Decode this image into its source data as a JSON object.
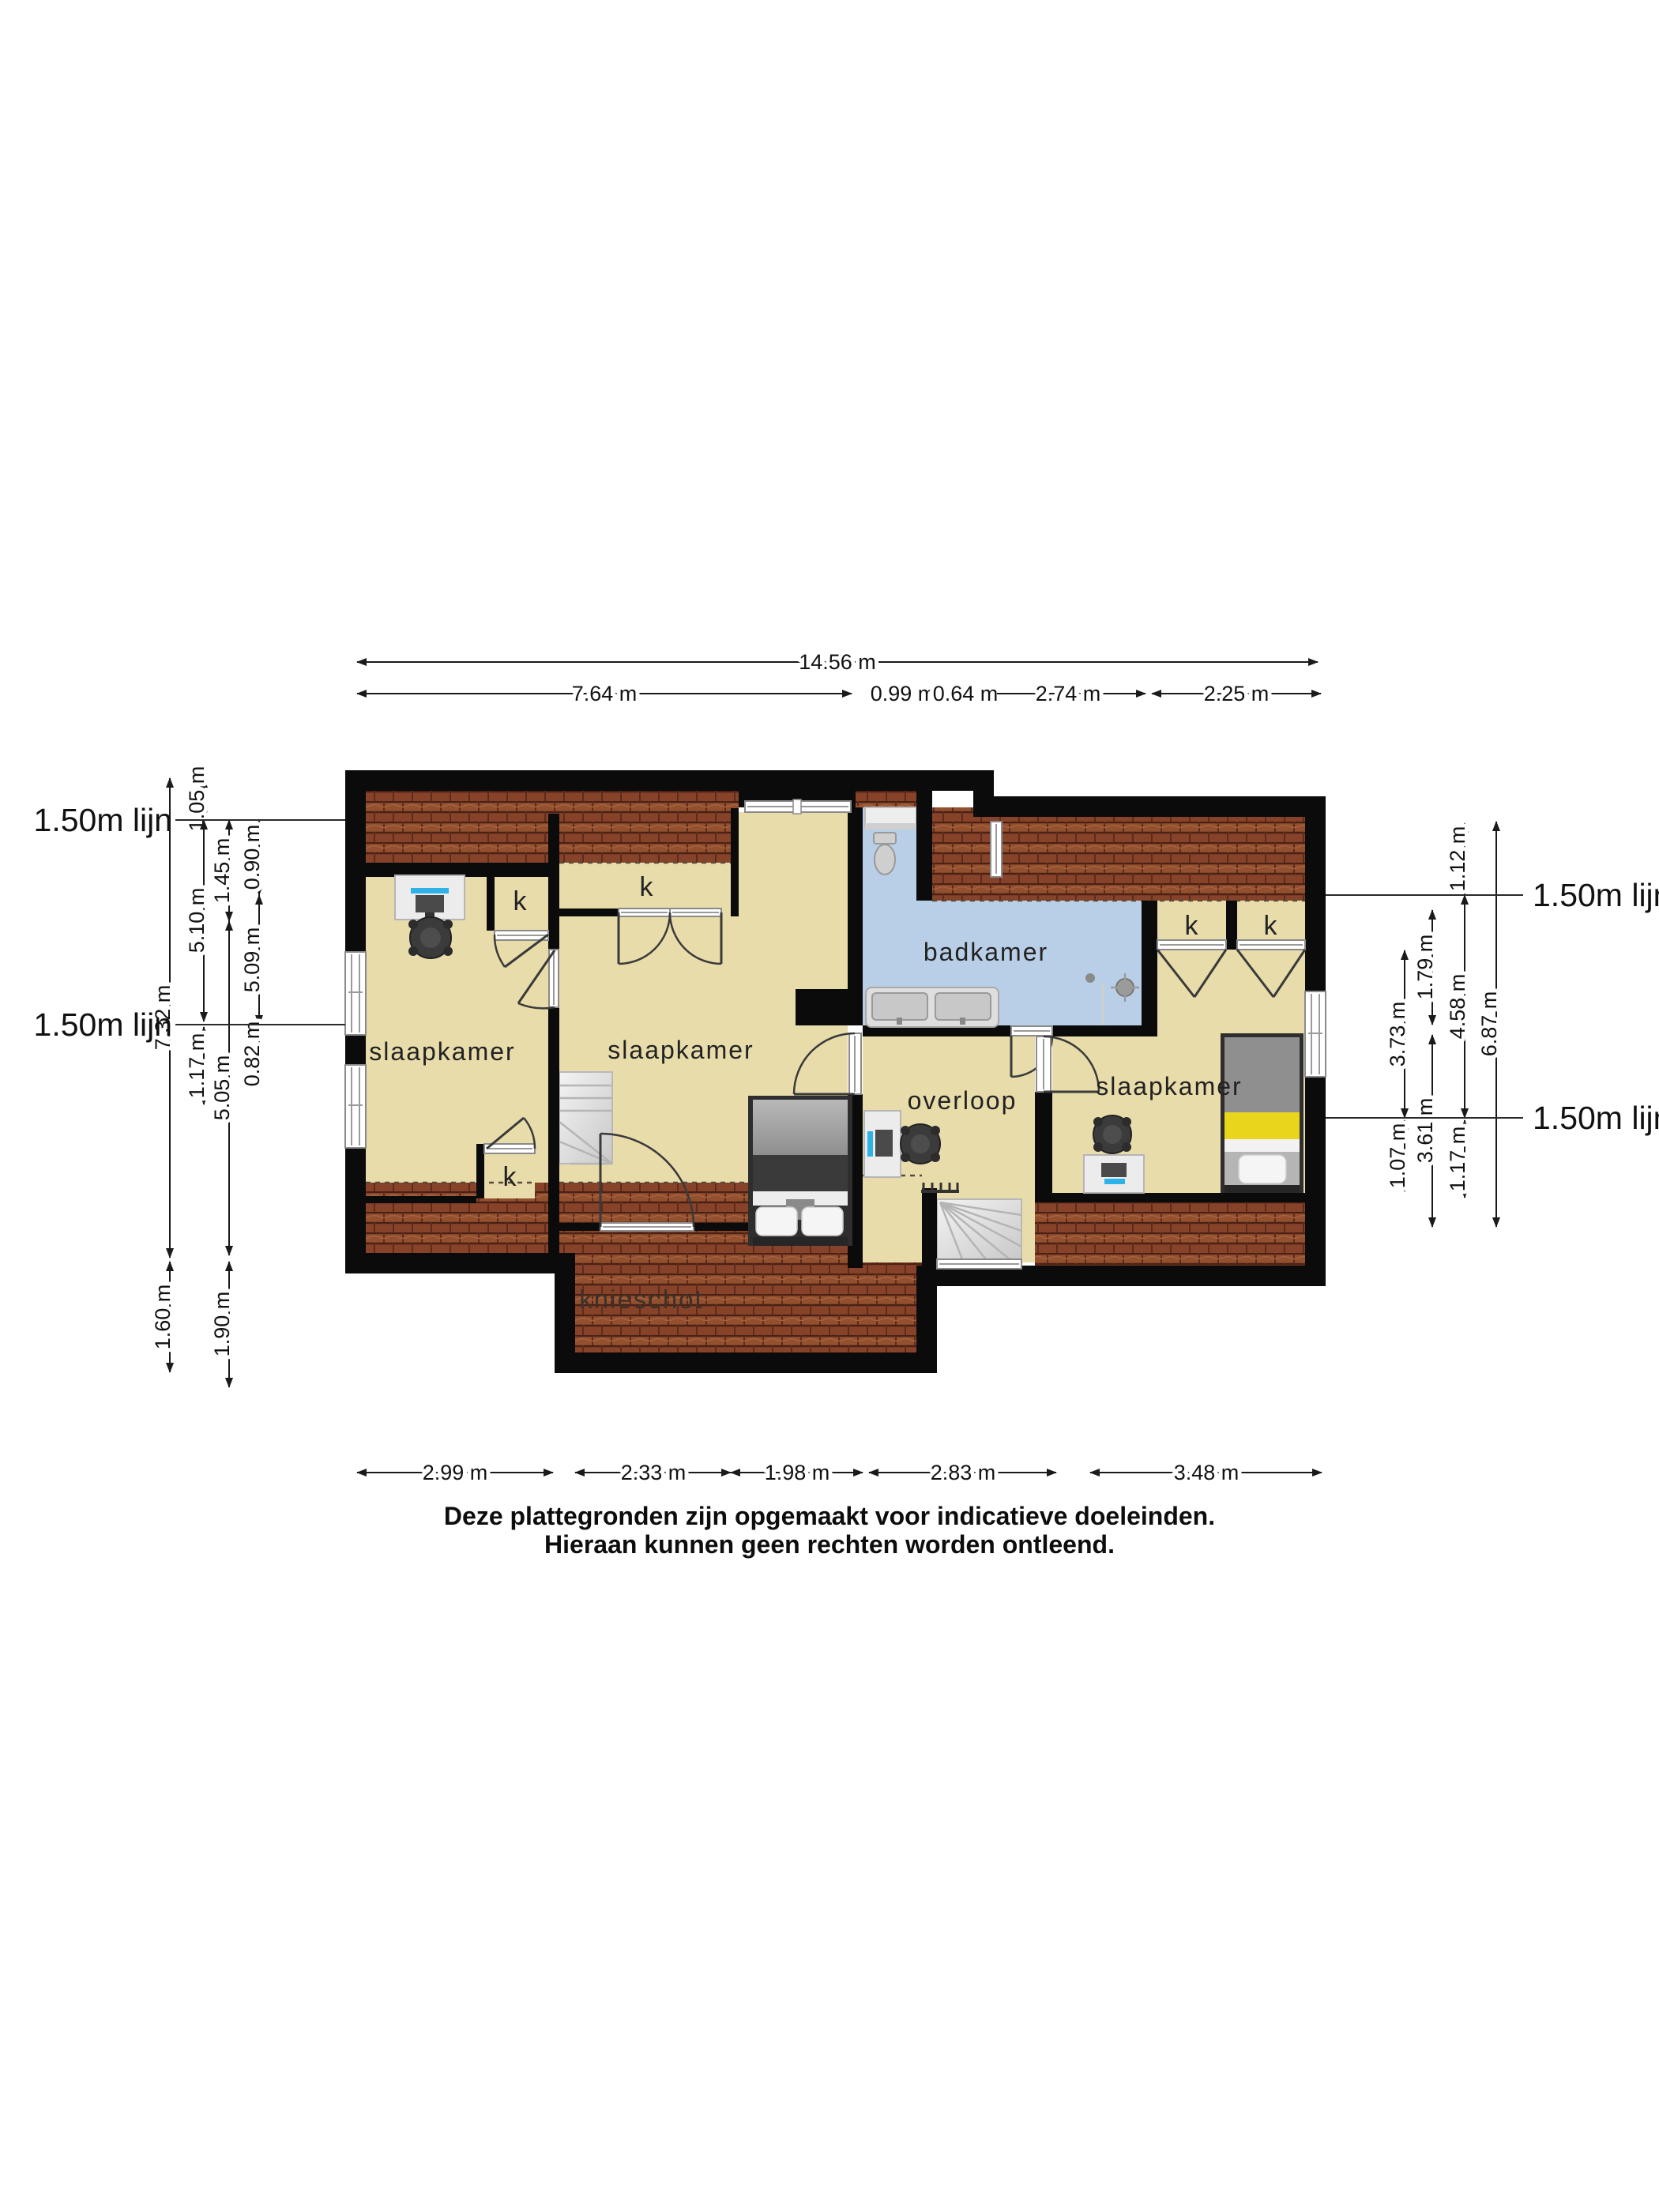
{
  "rooms": {
    "bedroom": "slaapkamer",
    "bathroom": "badkamer",
    "landing": "overloop",
    "knee_wall": "knieschot",
    "closet": "k"
  },
  "dims": {
    "top_total": "14.56 m",
    "top": [
      "7.64 m",
      "0.99 m",
      "0.64 m",
      "2.74 m",
      "2.25 m"
    ],
    "bottom": [
      "2.99 m",
      "2.33 m",
      "1.98 m",
      "2.83 m",
      "3.48 m"
    ],
    "left": [
      "7.32 m",
      "1.05 m",
      "5.10 m",
      "1.17 m",
      "1.45 m",
      "5.05 m",
      "1.90 m",
      "0.90 m",
      "5.09 m",
      "0.82 m",
      "1.60 m"
    ],
    "right": [
      "1.12 m",
      "4.58 m",
      "1.17 m",
      "1.79 m",
      "3.61 m",
      "3.73 m",
      "1.07 m",
      "6.87 m"
    ],
    "height_line_label": "1.50m lijn"
  },
  "disclaimer": [
    "Deze plattegronden zijn opgemaakt voor indicatieve doeleinden.",
    "Hieraan kunnen geen rechten worden ontleend."
  ],
  "colors": {
    "floor": "#e8dcab",
    "bathroom_floor": "#b9cfe7",
    "roof_tiles": "#8e4a33",
    "walls": "#0b0b0b",
    "bed_accent_yellow": "#e8d51c",
    "monitor_accent_blue": "#2db3e8"
  }
}
